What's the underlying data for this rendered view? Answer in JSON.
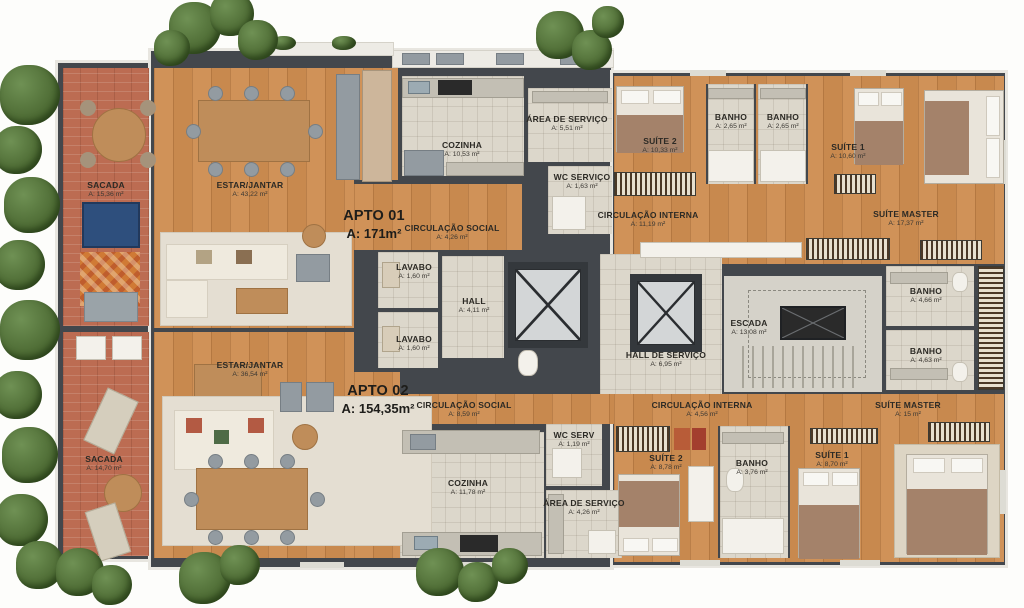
{
  "plan_title": "floor-plan-two-apartments",
  "colors": {
    "wall": "#43474c",
    "wood": "#cd8b52",
    "tile": "#dcd7cb",
    "brick": "#bc6c52",
    "accent_blue": "#2e4f7d",
    "accent_orange": "#d07a35"
  },
  "apto1": {
    "label": "APTO 01",
    "area": "A: 171m²"
  },
  "apto2": {
    "label": "APTO 02",
    "area": "A: 154,35m²"
  },
  "rooms": {
    "sacada_a1": {
      "name": "SACADA",
      "area": "A: 15,36 m²"
    },
    "estar_a1": {
      "name": "ESTAR/JANTAR",
      "area": "A: 43,22 m²"
    },
    "cozinha_a1": {
      "name": "COZINHA",
      "area": "A: 10,53 m²"
    },
    "area_servico_a1": {
      "name": "ÁREA DE SERVIÇO",
      "area": "A: 5,51 m²"
    },
    "wc_servico_a1": {
      "name": "WC SERVIÇO",
      "area": "A: 1,63 m²"
    },
    "circ_social_a1": {
      "name": "CIRCULAÇÃO SOCIAL",
      "area": "A: 4,26 m²"
    },
    "circ_interna_a1": {
      "name": "CIRCULAÇÃO INTERNA",
      "area": "A: 11,19 m²"
    },
    "suite2_a1": {
      "name": "SUÍTE 2",
      "area": "A: 10,33 m²"
    },
    "banho1_a1": {
      "name": "BANHO",
      "area": "A: 2,65 m²"
    },
    "banho2_a1": {
      "name": "BANHO",
      "area": "A: 2,65 m²"
    },
    "suite1_a1": {
      "name": "SUÍTE 1",
      "area": "A: 10,60 m²"
    },
    "suite_master_a1": {
      "name": "SUÍTE MASTER",
      "area": "A: 17,37 m²"
    },
    "lavabo_a1": {
      "name": "LAVABO",
      "area": "A: 1,60 m²"
    },
    "hall": {
      "name": "HALL",
      "area": "A: 4,11 m²"
    },
    "lavabo_a2": {
      "name": "LAVABO",
      "area": "A: 1,60 m²"
    },
    "escada": {
      "name": "ESCADA",
      "area": "A: 13,08 m²"
    },
    "hall_servico": {
      "name": "HALL DE SERVIÇO",
      "area": "A: 6,95 m²"
    },
    "banho_sm1": {
      "name": "BANHO",
      "area": "A: 4,66 m²"
    },
    "banho_sm2": {
      "name": "BANHO",
      "area": "A: 4,63 m²"
    },
    "estar_a2": {
      "name": "ESTAR/JANTAR",
      "area": "A: 36,54 m²"
    },
    "sacada_a2": {
      "name": "SACADA",
      "area": "A: 14,70 m²"
    },
    "circ_social_a2": {
      "name": "CIRCULAÇÃO SOCIAL",
      "area": "A: 8,59 m²"
    },
    "circ_interna_a2": {
      "name": "CIRCULAÇÃO INTERNA",
      "area": "A: 4,56 m²"
    },
    "cozinha_a2": {
      "name": "COZINHA",
      "area": "A: 11,78 m²"
    },
    "wc_serv_a2": {
      "name": "WC SERV",
      "area": "A: 1,19 m²"
    },
    "area_servico_a2": {
      "name": "ÁREA DE SERVIÇO",
      "area": "A: 4,26 m²"
    },
    "suite2_a2": {
      "name": "SUÍTE 2",
      "area": "A: 8,78 m²"
    },
    "banho_a2": {
      "name": "BANHO",
      "area": "A: 3,76 m²"
    },
    "suite1_a2": {
      "name": "SUÍTE 1",
      "area": "A: 8,70 m²"
    },
    "suite_master_a2": {
      "name": "SUÍTE MASTER",
      "area": "A: 15 m²"
    }
  }
}
